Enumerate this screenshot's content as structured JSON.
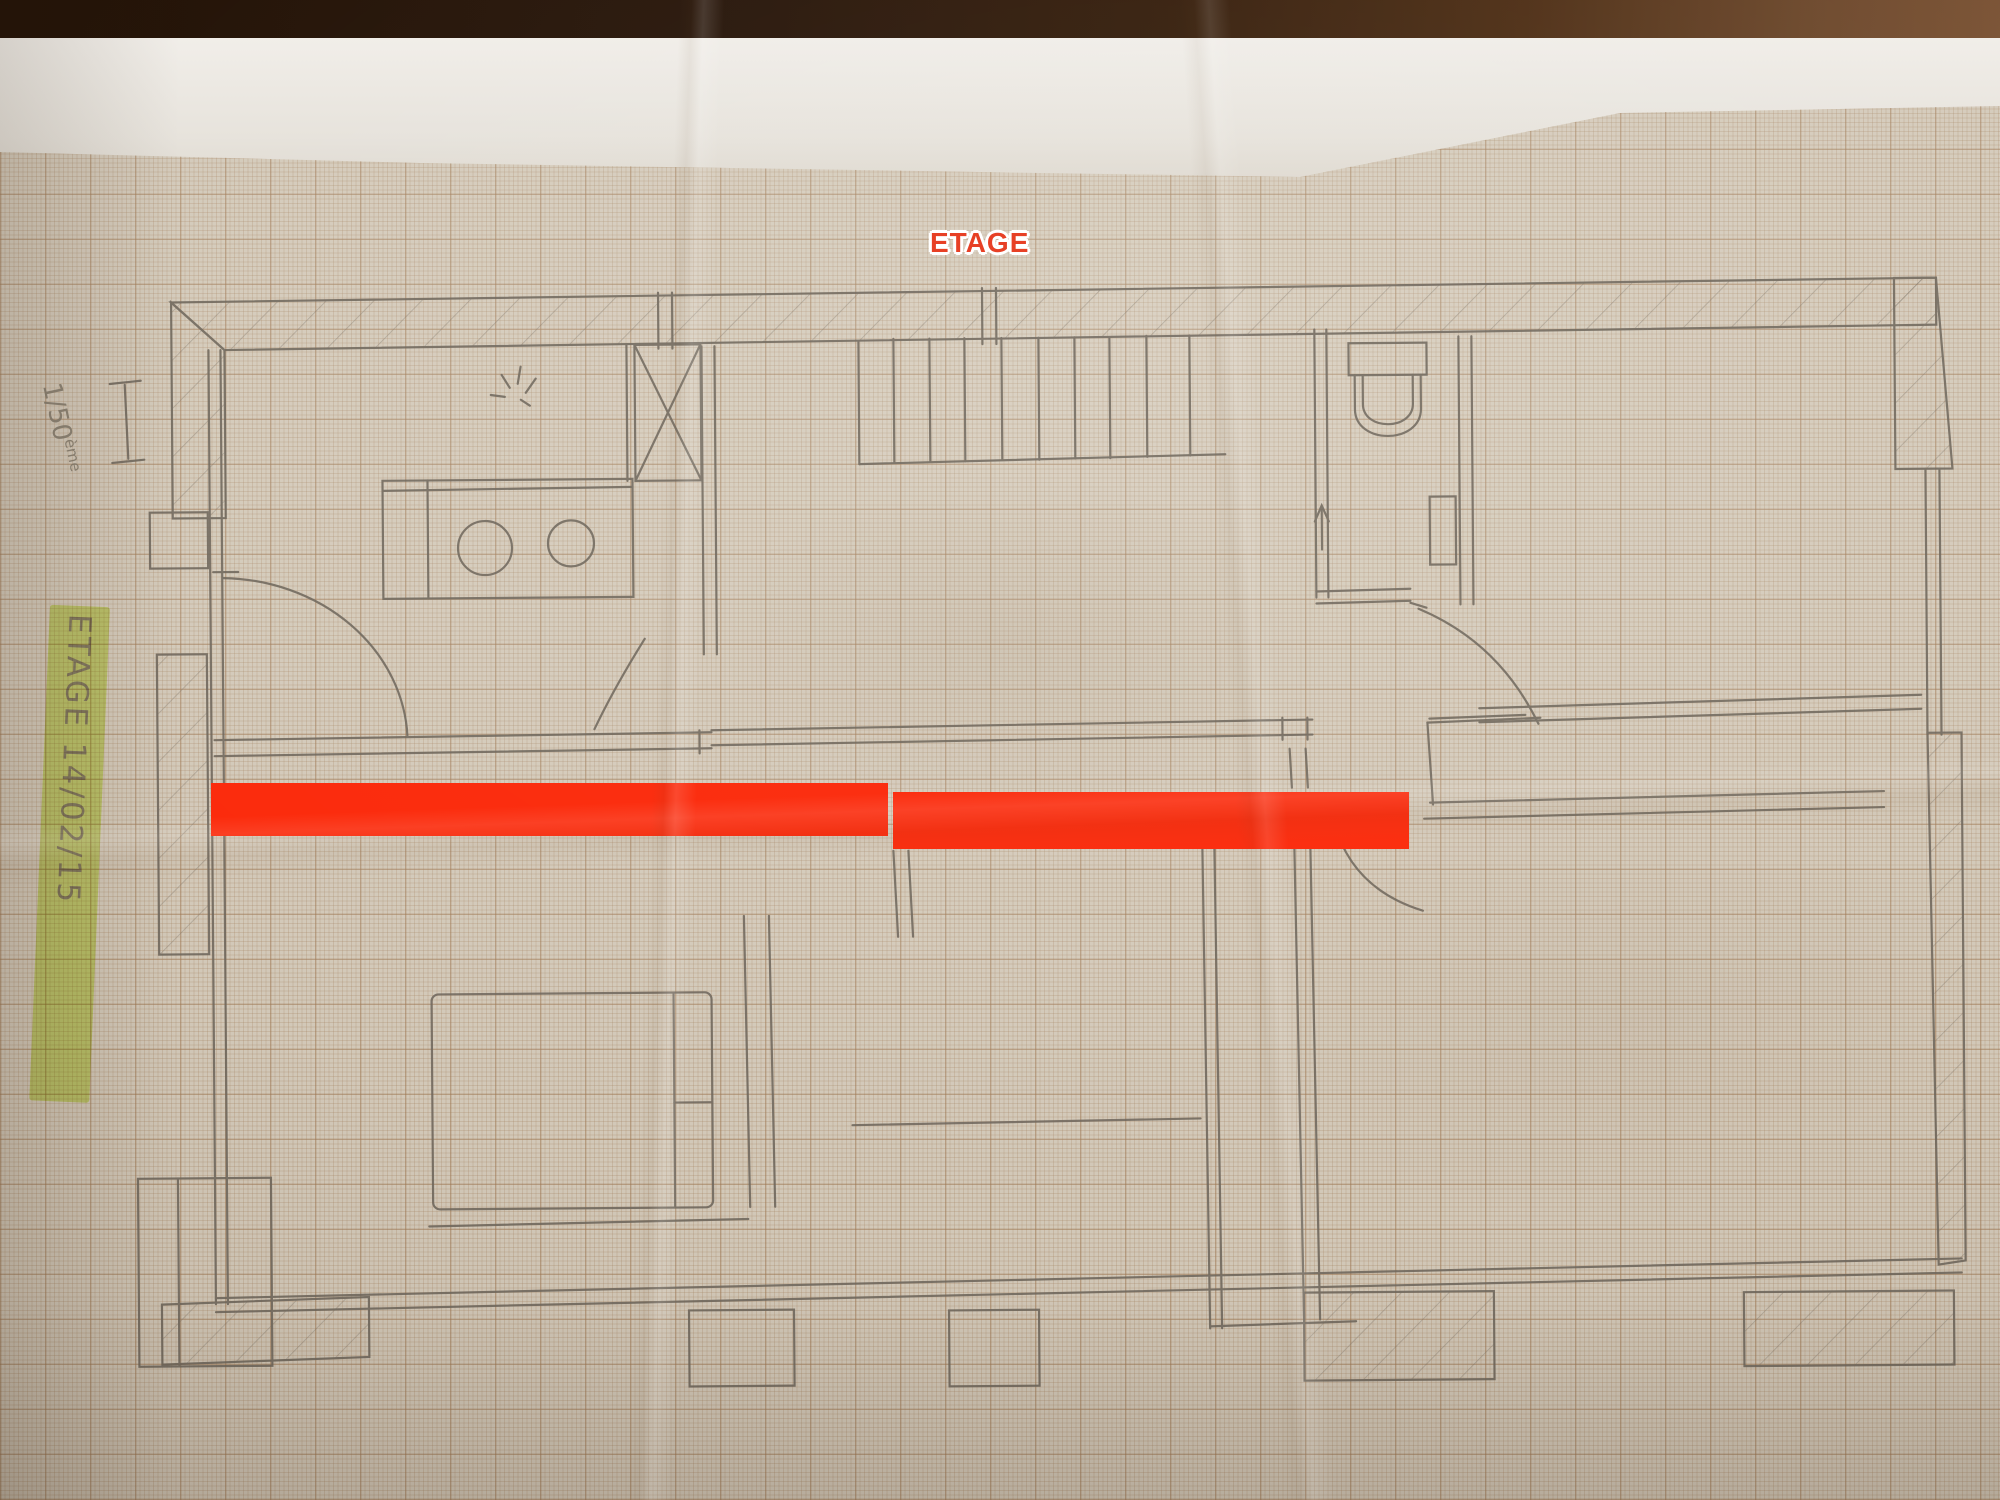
{
  "colors": {
    "graph-paper": "#d2c8b8",
    "pencil": "#6f675c",
    "marker-red": "#fb2a0b",
    "label-red": "#e6391d",
    "highlight-green": "#d6ef6f"
  },
  "labels": {
    "floor_title": "ETAGE",
    "side_note": "ETAGE 14/02/15",
    "scale_value": "1/50",
    "scale_suffix": "ème"
  },
  "annotations": {
    "red_bars": [
      {
        "x": 211,
        "y": 783,
        "w": 677,
        "h": 53
      },
      {
        "x": 893,
        "y": 792,
        "w": 516,
        "h": 57
      }
    ]
  },
  "plan": {
    "drawing_medium": "pencil floor plan on millimeter graph paper, photographed on a wooden table",
    "features": [
      "hatched exterior walls",
      "staircase with nine treads",
      "wc with toilet, hand basin and up-arrow",
      "kitchen counter with two round bowls",
      "ceiling light symbol",
      "shower box marked with a cross",
      "five door swing arcs",
      "double bed",
      "balcony ledges and wall piers"
    ]
  }
}
